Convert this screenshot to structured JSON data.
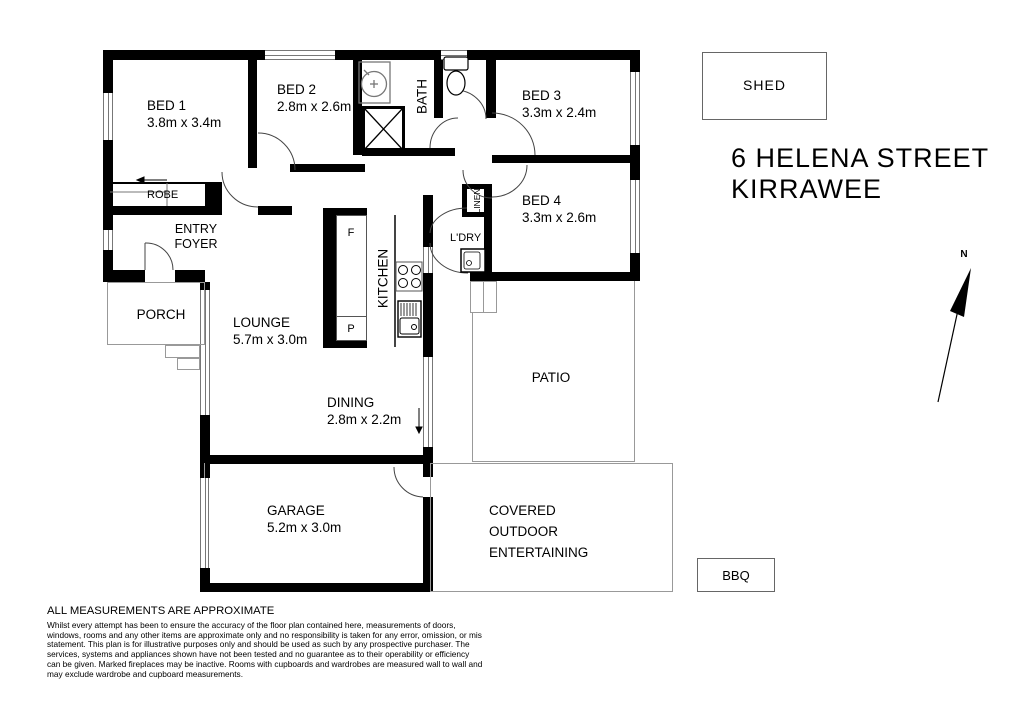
{
  "title": {
    "line1": "6 HELENA STREET",
    "line2": "KIRRAWEE"
  },
  "north_label": "N",
  "rooms": {
    "bed1": {
      "name": "BED 1",
      "dims": "3.8m x 3.4m"
    },
    "bed2": {
      "name": "BED 2",
      "dims": "2.8m x 2.6m"
    },
    "bed3": {
      "name": "BED 3",
      "dims": "3.3m x 2.4m"
    },
    "bed4": {
      "name": "BED 4",
      "dims": "3.3m x 2.6m"
    },
    "bath": {
      "name": "BATH"
    },
    "robe": {
      "name": "ROBE"
    },
    "entry": {
      "line1": "ENTRY",
      "line2": "FOYER"
    },
    "porch": {
      "name": "PORCH"
    },
    "lounge": {
      "name": "LOUNGE",
      "dims": "5.7m x 3.0m"
    },
    "kitchen": {
      "name": "KITCHEN"
    },
    "dining": {
      "name": "DINING",
      "dims": "2.8m x 2.2m"
    },
    "garage": {
      "name": "GARAGE",
      "dims": "5.2m x 3.0m"
    },
    "patio": {
      "name": "PATIO"
    },
    "covered": {
      "line1": "COVERED",
      "line2": "OUTDOOR",
      "line3": "ENTERTAINING"
    },
    "laundry": {
      "name": "L'DRY"
    },
    "linen": {
      "name": "LINEN"
    },
    "shed": {
      "name": "SHED"
    },
    "bbq": {
      "name": "BBQ"
    },
    "fridge": "F",
    "pantry": "P"
  },
  "disclaimer": {
    "title": "ALL MEASUREMENTS ARE APPROXIMATE",
    "lines": [
      "Whilst every attempt has been to ensure the accuracy of the floor plan contained here, measurements of doors,",
      "windows, rooms and any other items are approximate only and no responsibility is taken for any error, omission, or mis",
      "statement. This plan is for illustrative purposes only and should be used as such by any prospective purchaser. The",
      "services, systems and appliances shown have not been tested and no guarantee as to their operability or efficiency",
      "can be given. Marked fireplaces may be inactive. Rooms with cupboards and wardrobes are measured wall to wall and",
      "may exclude wardrobe and cupboard measurements."
    ]
  },
  "colors": {
    "wall": "#000000",
    "outline": "#999999",
    "text": "#000000"
  }
}
